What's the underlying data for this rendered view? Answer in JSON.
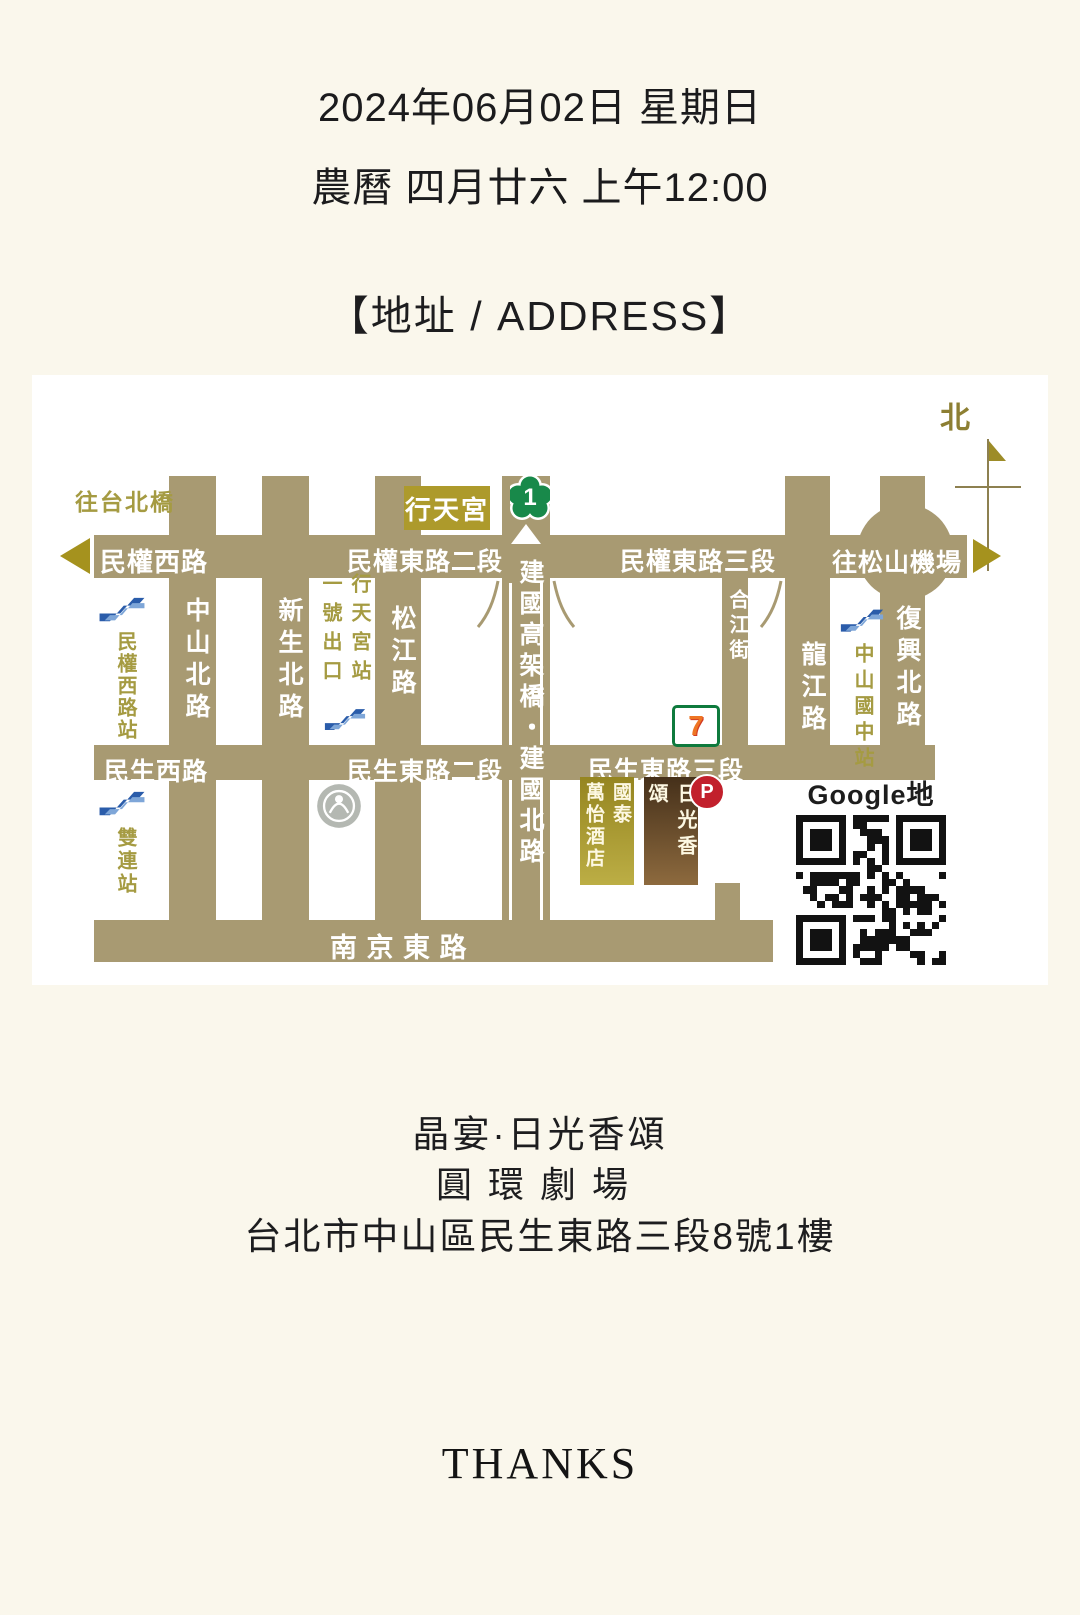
{
  "header": {
    "date_line": "2024年06月02日 星期日",
    "lunar_line": "農曆 四月廿六 上午12:00",
    "address_heading": "【地址 / ADDRESS】"
  },
  "map": {
    "compass_north": "北",
    "roads_horizontal": {
      "minquan_west": "民權西路",
      "minquan_east_2": "民權東路二段",
      "minquan_east_3": "民權東路三段",
      "to_songshan_airport": "往松山機場",
      "minsheng_west": "民生西路",
      "minsheng_east_2": "民生東路二段",
      "minsheng_east_3": "民生東路三段",
      "nanjing_east": "南 京 東 路"
    },
    "roads_vertical": {
      "zhongshan_north": "中山北路",
      "xinsheng_north": "新生北路",
      "songjiang": "松江路",
      "jianguo": "建國高架橋・建國北路",
      "hejiang": "合江街",
      "longjiang": "龍江路",
      "fuxing_north": "復興北路"
    },
    "labels": {
      "to_taipei_bridge": "往台北橋",
      "xingtian_temple": "行天宮",
      "highway_shield": "1",
      "xingtian_exit_col1": "行天宮站",
      "xingtian_exit_col2": "一號出口",
      "minquan_west_station": "民權西路站",
      "shuanglian_station": "雙連站",
      "zhongshan_junior_high_station": "中山國中站",
      "google_map": "Google地圖",
      "parking": "P",
      "seven_eleven": "7"
    },
    "buildings": {
      "hotel_col1": "國泰",
      "hotel_col2": "萬怡酒店",
      "venue_block": "日光香頌"
    },
    "colors": {
      "road": "#a89a72",
      "olive_label": "#a59b42",
      "temple_badge": "#ad9a2b",
      "venue_dark": "#45301a",
      "hotel_gold": "#958520",
      "parking_red": "#c2202c",
      "shield_green": "#18894a"
    }
  },
  "venue": {
    "name": "晶宴·日光香頌",
    "hall": "圓環劇場",
    "address": "台北市中山區民生東路三段8號1樓"
  },
  "footer": {
    "thanks": "THANKS"
  }
}
